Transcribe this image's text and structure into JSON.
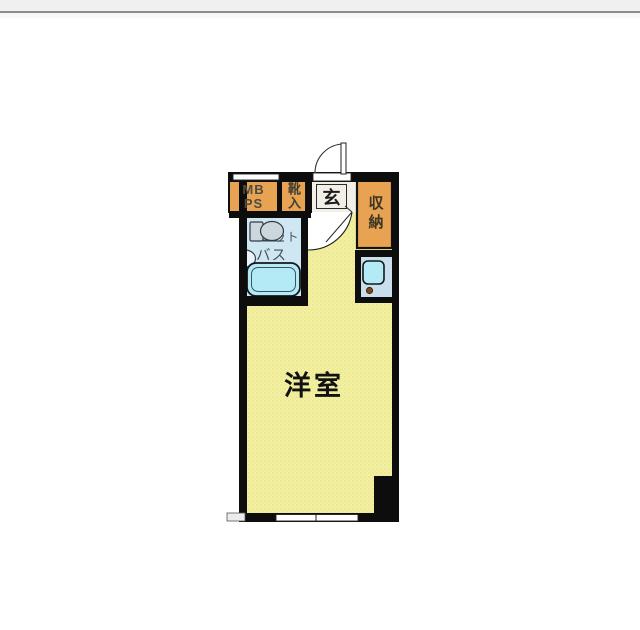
{
  "floorplan": {
    "rooms": {
      "mb_ps": "MB\nPS",
      "shoe_cabinet": "靴入",
      "entrance": "玄",
      "storage": "収納",
      "unit_bath_line1": "ユニット",
      "unit_bath_line2": "バス",
      "main_room": "洋室"
    },
    "colors": {
      "wall": "#0d0d0d",
      "room_yellow": "#f2ef9f",
      "room_yellow_dot": "#e4e08c",
      "closet_orange": "#e7a351",
      "bath_blue": "#cfe7f2",
      "kitchen_blue": "#c9e0ec",
      "fixture_cyan": "#b4eaf6",
      "hall_floor": "#f1efe7",
      "toilet_gray": "#ccd6dd",
      "knob_brown": "#7a4523",
      "bath_text": "#49525a",
      "chrome_bar": "#f0f0f0",
      "chrome_line": "#8c8c8c"
    }
  }
}
